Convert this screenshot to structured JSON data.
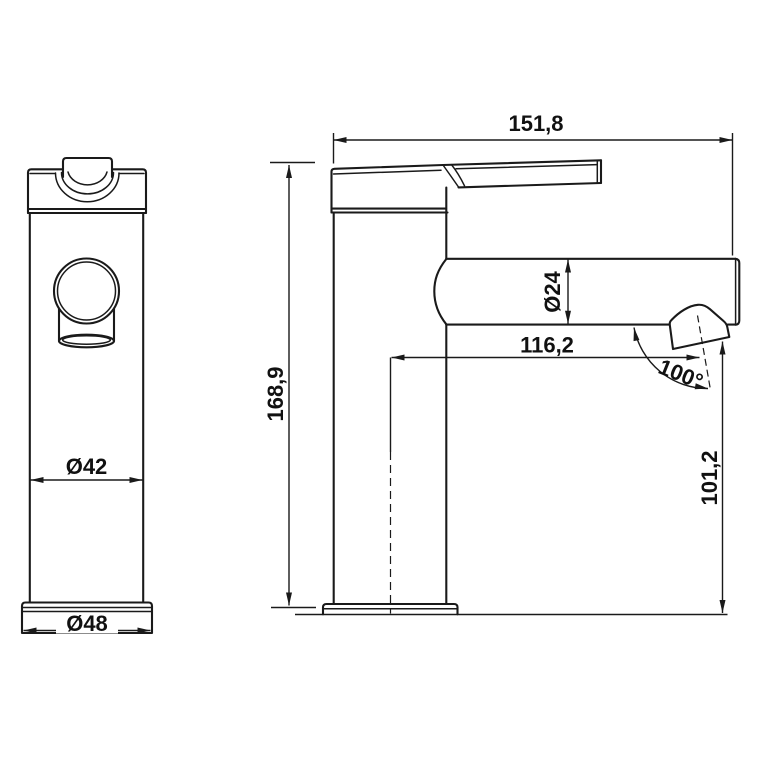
{
  "page": {
    "background": "#ffffff",
    "description": "Technical dimension drawing of a single-lever basin faucet, front and side views"
  },
  "drawing": {
    "line_color": "#1a1a1a",
    "front_view": {
      "labels": {
        "body_diameter": "Ø42",
        "base_diameter": "Ø48"
      }
    },
    "side_view": {
      "labels": {
        "overall_length": "151,8",
        "overall_height": "168,9",
        "spout_diameter": "Ø24",
        "spout_reach": "116,2",
        "spout_angle": "100°",
        "outlet_height": "101,2"
      }
    }
  }
}
